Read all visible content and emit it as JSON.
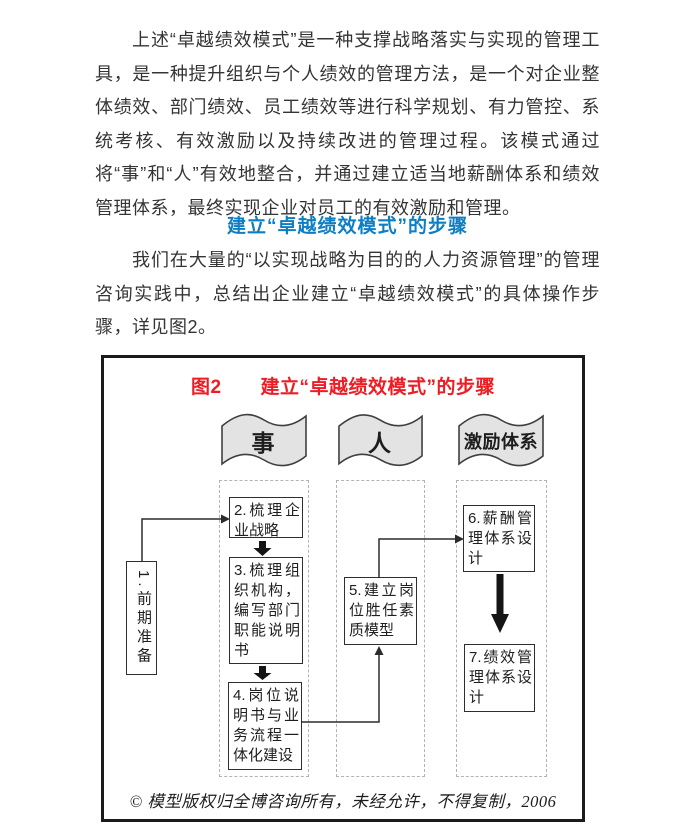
{
  "document": {
    "paragraph1": "上述“卓越绩效模式”是一种支撑战略落实与实现的管理工具，是一种提升组织与个人绩效的管理方法，是一个对企业整体绩效、部门绩效、员工绩效等进行科学规划、有力管控、系统考核、有效激励以及持续改进的管理过程。该模式通过将“事”和“人”有效地整合，并通过建立适当地薪酬体系和绩效管理体系，最终实现企业对员工的有效激励和管理。",
    "section_heading": "建立“卓越绩效模式”的步骤",
    "paragraph2": "我们在大量的“以实现战略为目的的人力资源管理”的管理咨询实践中，总结出企业建立“卓越绩效模式”的具体操作步骤，详见图2。"
  },
  "figure": {
    "title": "图2　　建立“卓越绩效模式”的步骤",
    "lanes": [
      {
        "banner": "事"
      },
      {
        "banner": "人"
      },
      {
        "banner": "激励体系"
      }
    ],
    "steps": {
      "step1": "1.前期准备",
      "step2": "2.梳理企业战略",
      "step3": "3.梳理组织机构，编写部门职能说明书",
      "step4": "4.岗位说明书与业务流程一体化建设",
      "step5": "5.建立岗位胜任素质模型",
      "step6": "6.薪酬管理体系设计",
      "step7": "7.绩效管理体系设计"
    },
    "copyright": "© 模型版权归全博咨询所有，未经允许，不得复制，2006"
  },
  "colors": {
    "body_text": "#343434",
    "heading_blue": "#0d7ec3",
    "figure_title_red": "#ee1c23",
    "banner_fill": "#e3e3e3",
    "line_color": "#2b2b2b"
  }
}
